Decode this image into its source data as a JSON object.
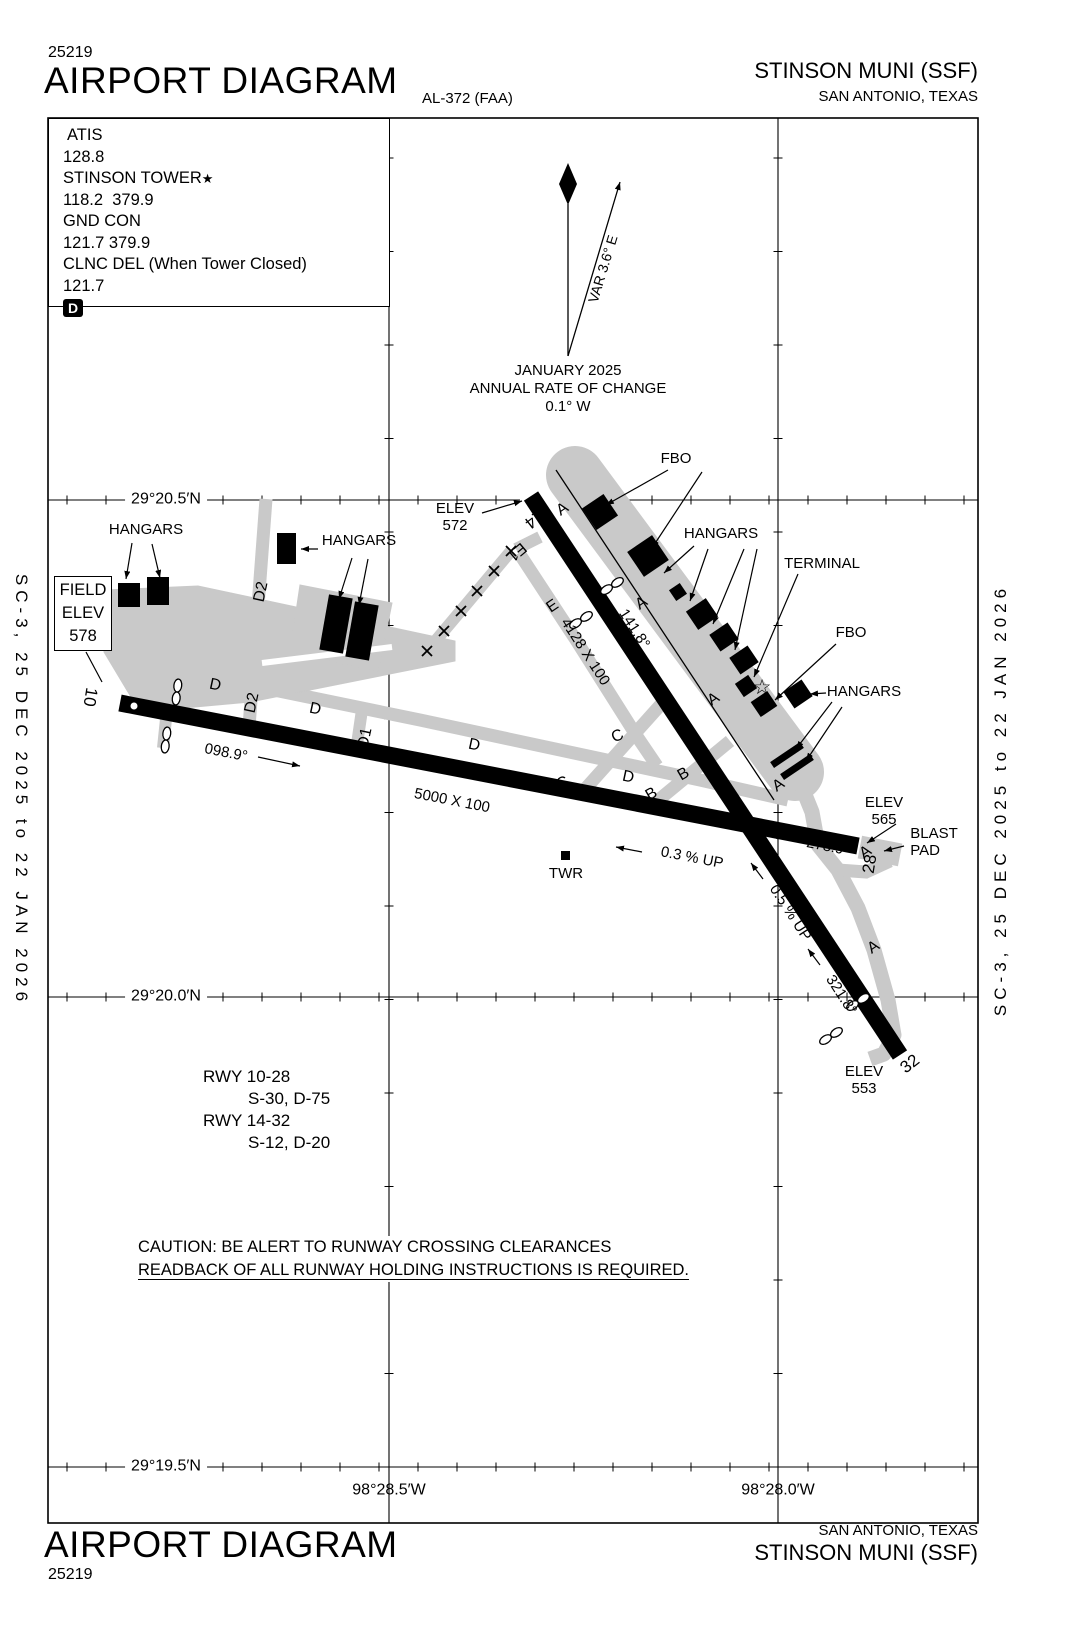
{
  "header": {
    "chart_number": "25219",
    "title": "AIRPORT DIAGRAM",
    "procedure_id": "AL-372 (FAA)",
    "airport": "STINSON MUNI (SSF)",
    "city": "SAN ANTONIO, TEXAS"
  },
  "footer": {
    "title": "AIRPORT DIAGRAM",
    "chart_number": "25219",
    "airport": "STINSON MUNI (SSF)",
    "city": "SAN ANTONIO, TEXAS"
  },
  "margins": {
    "left": "SC-3, 25 DEC 2025 to 22 JAN 2026",
    "right": "SC-3, 25 DEC 2025 to 22 JAN 2026"
  },
  "comm_box": {
    "atis_label": "ATIS",
    "atis": "128.8",
    "tower_label": "STINSON TOWER",
    "tower_star": "★",
    "tower": "118.2  379.9",
    "gnd_label": "GND CON",
    "gnd": "121.7 379.9",
    "clnc_label": "CLNC DEL (When Tower Closed)",
    "clnc": "121.7",
    "hold_symbol": "D"
  },
  "compass": {
    "variation": "VAR 3.6° E",
    "date": "JANUARY 2025",
    "rate_line": "ANNUAL RATE OF CHANGE",
    "rate": "0.1° W"
  },
  "graticule": {
    "lat_1": "29°20.5′N",
    "lat_2": "29°20.0′N",
    "lat_3": "29°19.5′N",
    "lon_1": "98°28.5′W",
    "lon_2": "98°28.0′W"
  },
  "field_elev": {
    "line1": "FIELD",
    "line2": "ELEV",
    "line3": "578"
  },
  "features": {
    "hangars": "HANGARS",
    "fbo": "FBO",
    "terminal": "TERMINAL",
    "blast_line1": "BLAST",
    "blast_line2": "PAD",
    "twr": "TWR",
    "beacon": "☆",
    "elev_label": "ELEV",
    "elev_rwy14": "572",
    "elev_rwy28": "565",
    "elev_rwy32": "553"
  },
  "runway_10_28": {
    "num_10": "10",
    "num_28": "28",
    "hdg_10": "098.9°",
    "hdg_28": "278.9°",
    "dimensions": "5000 X 100",
    "gradient": "0.3 % UP"
  },
  "runway_14_32": {
    "num_14": "14",
    "num_32": "32",
    "hdg_14": "141.8°",
    "hdg_32": "321.8°",
    "dimensions": "4128 X 100",
    "gradient": "0.5 % UP"
  },
  "taxiways": {
    "a": "A",
    "b": "B",
    "c": "C",
    "d": "D",
    "d1": "D1",
    "d2": "D2",
    "e": "E",
    "e1": "E1"
  },
  "runway_data": {
    "rwy_10_28": "RWY 10-28",
    "rwy_10_28_strength": "S-30, D-75",
    "rwy_14_32": "RWY 14-32",
    "rwy_14_32_strength": "S-12, D-20"
  },
  "caution": {
    "line1": "CAUTION: BE ALERT TO RUNWAY CROSSING CLEARANCES",
    "line2": "READBACK OF ALL RUNWAY HOLDING INSTRUCTIONS IS REQUIRED."
  }
}
